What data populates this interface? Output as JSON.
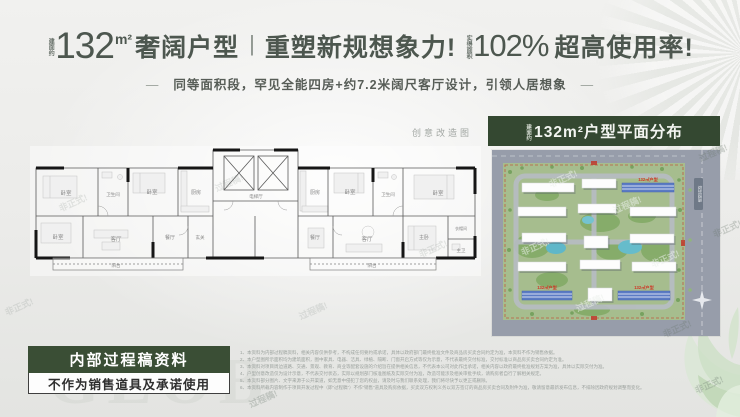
{
  "header": {
    "area_prefix": "建面约",
    "area_value": "132",
    "area_unit": "m²",
    "title_1": "奢阔户型",
    "divider": "|",
    "title_2": "重塑新规想象力!",
    "rate_prefix": "实得面积",
    "rate_value": "102%",
    "title_3": "超高使用率!",
    "dash": "—",
    "subtitle": "同等面积段，罕见全能四房+约7.2米阔尺客厅设计，引领人居想象"
  },
  "floorplan": {
    "caption": "创意改造图",
    "rooms": [
      "卧室",
      "卫生间",
      "卧室",
      "厨房",
      "卧室",
      "客厅",
      "餐厅",
      "玄关",
      "阳台",
      "电梯厅",
      "厨房",
      "卧室",
      "卫生间",
      "卧室",
      "餐厅",
      "客厅",
      "主卧",
      "衣帽间",
      "主卫",
      "阳台"
    ]
  },
  "siteplan": {
    "title_prefix": "建面约",
    "title": "132m²户型平面分布",
    "road_label": "规划道路",
    "building_tags": [
      "132㎡户型",
      "132㎡户型",
      "132㎡户型"
    ]
  },
  "stamp": {
    "line1": "内部过程稿资料",
    "line2": "不作为销售道具及承诺使用"
  },
  "disclaimer": {
    "lines": [
      "1、本资料为内部过程稿资料，相关内容仅供参考，不构成任何要约或承诺，具体以政府部门最终批准文件及商品房买卖合同约定为准，本资料不作为销售依据。",
      "2、本户型图所示面积均为建筑面积，图中家具、电器、洁具、绿植、隔断、门窗开启方式等仅为示意，不代表最终交付标准，交付标准以商品房买卖合同约定为准。",
      "3、本资料对项目周边道路、交通、景观、教育、商业等配套设施的介绍旨在提供相关信息，不代表本公司对此作出承诺，相关内容以政府最终批准规划方案为准，具体以实际交付为准。",
      "4、户型创意改造仅为设计示意，不代表交付状态，实际以规划部门核准图纸及实际交付为准，改造可能涉及相关审批手续，请购房者自行了解相关规定。",
      "5、本资料部分图片、文字来源于公开渠道，如无意中侵犯了您的权益，请及时与我们联系处理，我们将尽快予以更正或删除。",
      "6、本资料所载内容制作于项目开发过程中（即“过程稿”）不作“销售”道具及购房依据，买卖双方权利义务以双方签订的商品房买卖合同及附件为准，敬请留意最新发布信息，不排除因政府规划调整而变化。"
    ]
  },
  "watermarks": {
    "informal": "非正式!",
    "draft": "过程稿!",
    "letters": "GLOB"
  }
}
